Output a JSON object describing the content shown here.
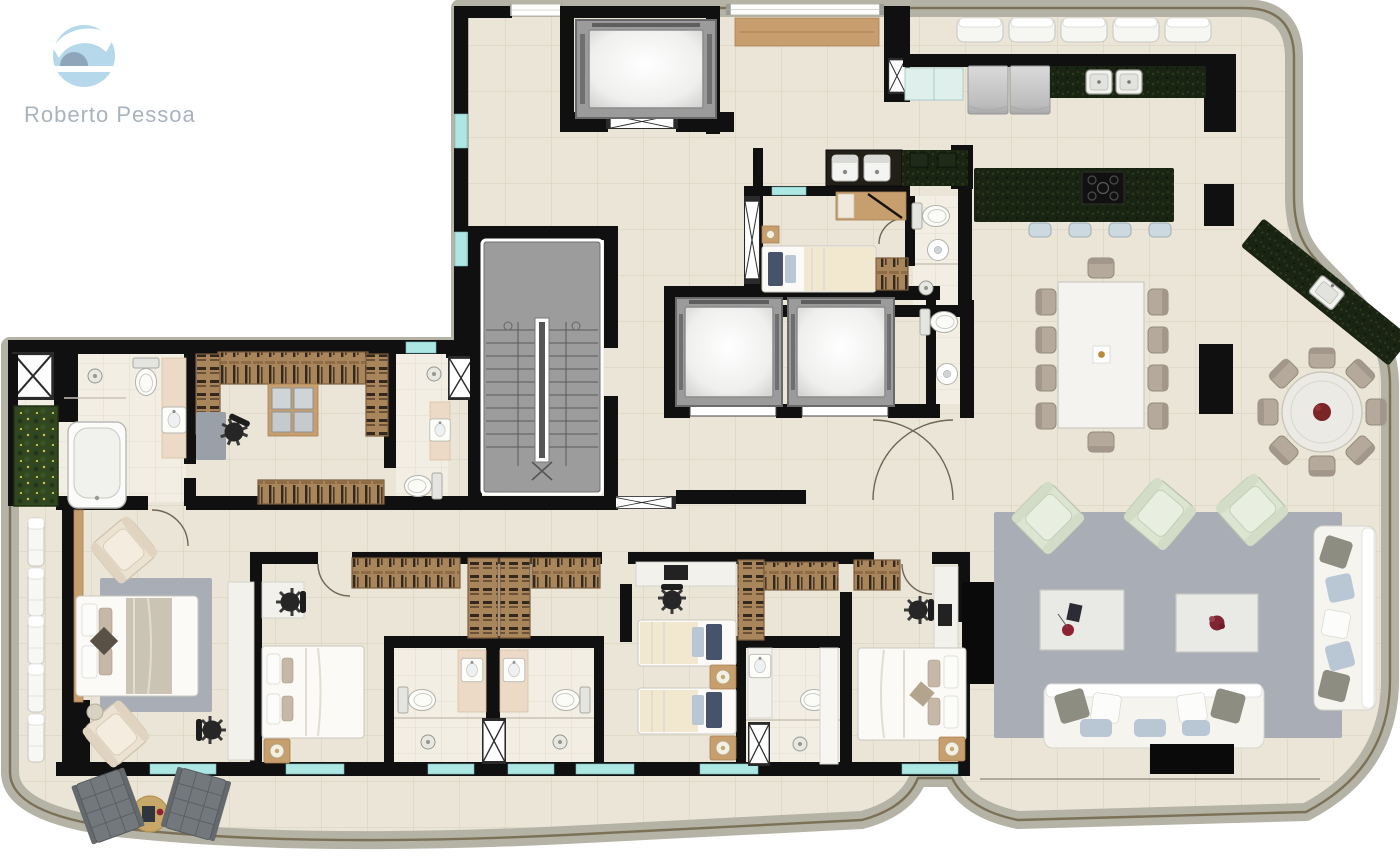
{
  "brand": {
    "name": "Roberto Pessoa"
  },
  "palette": {
    "wall": "#101010",
    "floor": "#eae5d6",
    "floor_line": "#d6cfbc",
    "bath_floor": "#f2eee3",
    "bath_line": "#ded8c8",
    "outline_shadow": "#b5b2a6",
    "railing": "#7a7157",
    "stair": "#9c9c9c",
    "shaft": "#9b9b9b",
    "granite": "#1a2412",
    "wood": "#c79e6d",
    "wood_dark": "#a47b52",
    "clothes_dark": "#33281d",
    "rug": "#a9aeb6",
    "rug_small": "#9aa0a8",
    "sofa": "#f5f4ef",
    "pillow_gray": "#8e8d82",
    "pillow_blue": "#b9c6d4",
    "sage": "#dce4d2",
    "taupe": "#b4a99b",
    "glass": "#ade7e4",
    "garden": "#31471f",
    "garden_dot": "#d9c54b",
    "peach": "#ecd9c6",
    "dark_lounger": "#73787c",
    "cream": "#f2e8cf",
    "navy": "#46536b",
    "accent_red": "#8e2230",
    "logo_blue": "#b5d9ea",
    "logo_dome": "#8fa6ba",
    "logo_text": "#a9b3bd"
  },
  "plan": {
    "areas": [
      "entrance-hall",
      "service-elevator",
      "social-elevators",
      "stairwell",
      "kitchen",
      "laundry",
      "staff-bedroom",
      "staff-bathroom",
      "guest-toilet",
      "dining-room",
      "gourmet-terrace",
      "living-room",
      "master-suite",
      "walk-in-closet",
      "master-bathroom",
      "bedroom-2",
      "bedroom-3-twin",
      "bedroom-4",
      "ensuite-bathrooms",
      "west-balcony",
      "south-terrace"
    ],
    "counts": {
      "dining_table_seats": 10,
      "round_table_seats": 8,
      "island_stools": 4,
      "balcony_benches": 5,
      "west_balcony_loungers": 5,
      "living_armchairs": 3,
      "living_sofas": 2,
      "bedrooms": 5,
      "elevators": 3
    }
  }
}
